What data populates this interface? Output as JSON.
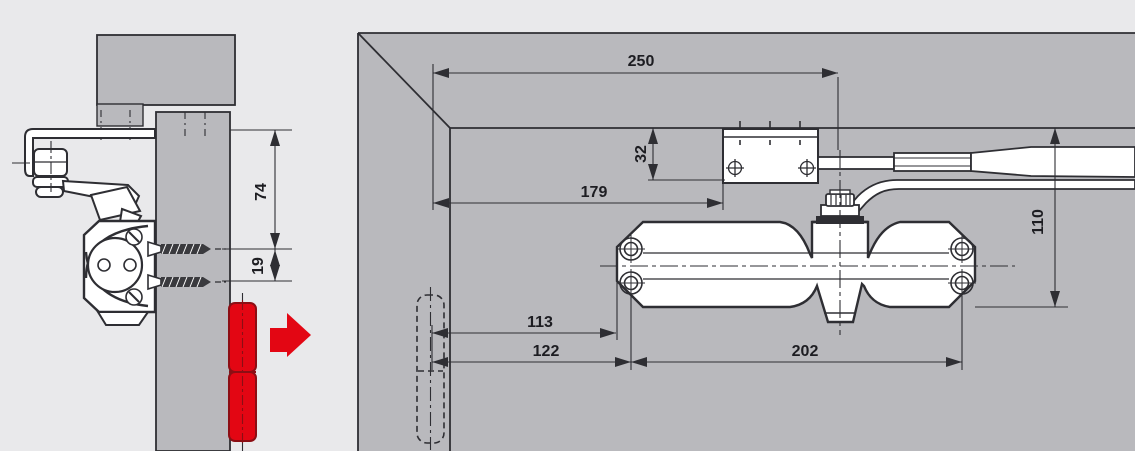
{
  "title": "Overhead door closer mounting dimensions diagram",
  "colors": {
    "background": "#e9e9eb",
    "wall_fill": "#b9b9bd",
    "line": "#2e2e33",
    "part_fill": "#ffffff",
    "accent_red": "#e30613",
    "accent_red_dark": "#8c0e14",
    "text": "#1d1d22"
  },
  "dimensions": {
    "left_view": {
      "frame_to_top_screw": "74",
      "screw_spacing": "19"
    },
    "right_view": {
      "corner_to_spindle": "250",
      "corner_to_bracket": "179",
      "frame_to_arm_bracket": "32",
      "frame_to_body_bottom": "110",
      "hinge_to_body_end": "113",
      "hinge_to_mount_hole": "122",
      "mount_hole_spacing": "202"
    }
  }
}
